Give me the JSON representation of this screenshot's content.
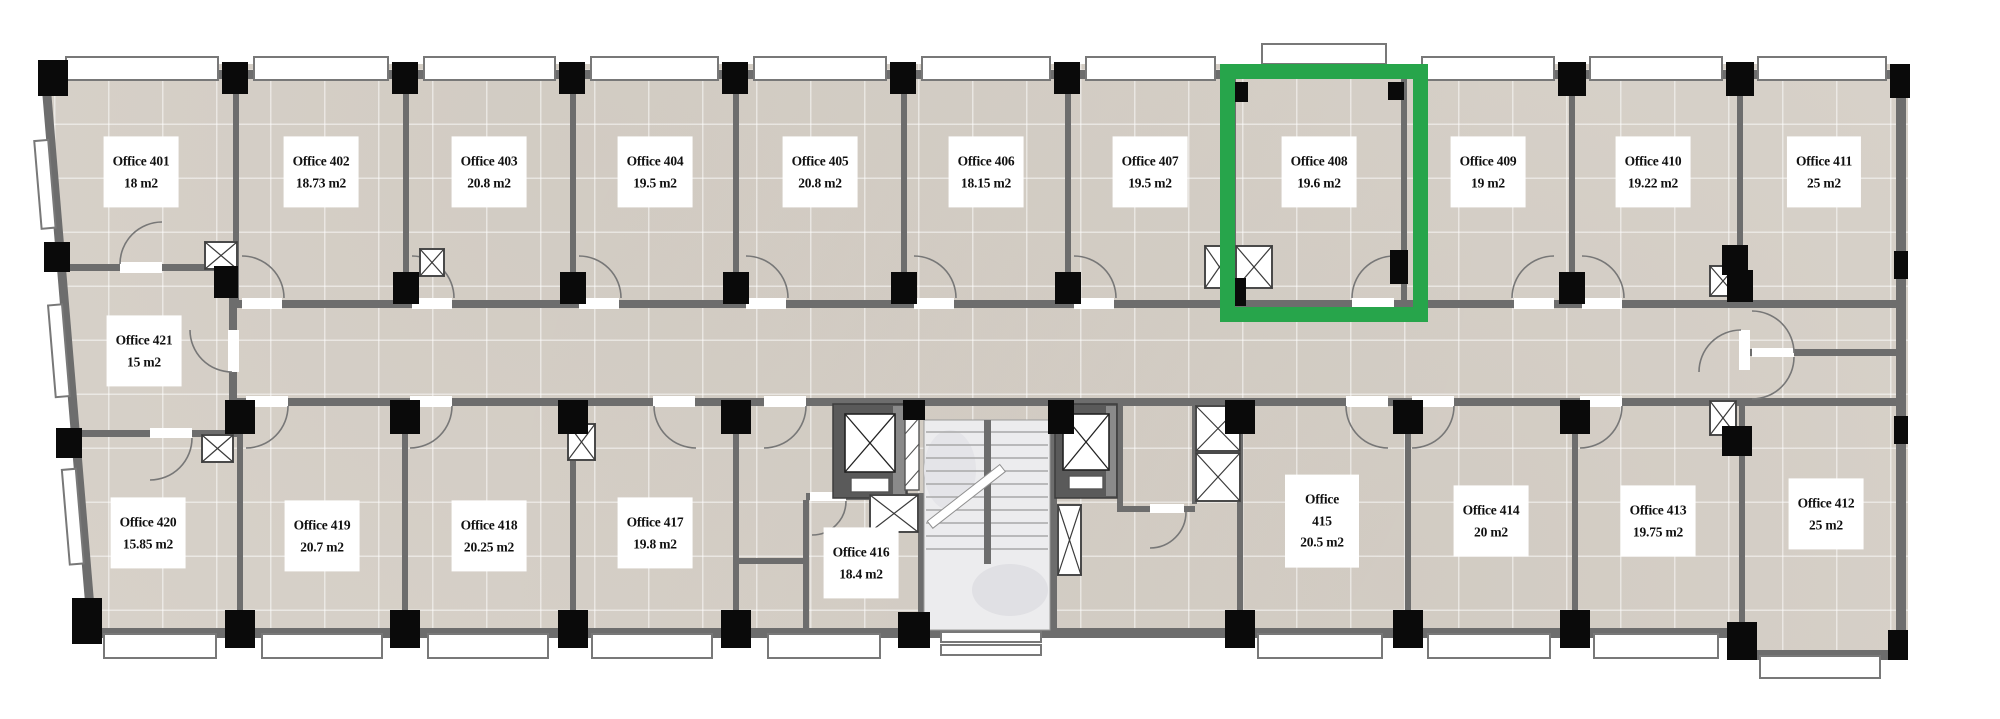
{
  "rooms": [
    {
      "name": "Office 401",
      "area": "18 m2",
      "highlighted": false
    },
    {
      "name": "Office 402",
      "area": "18.73 m2",
      "highlighted": false
    },
    {
      "name": "Office 403",
      "area": "20.8 m2",
      "highlighted": false
    },
    {
      "name": "Office 404",
      "area": "19.5 m2",
      "highlighted": false
    },
    {
      "name": "Office 405",
      "area": "20.8 m2",
      "highlighted": false
    },
    {
      "name": "Office 406",
      "area": "18.15 m2",
      "highlighted": false
    },
    {
      "name": "Office 407",
      "area": "19.5 m2",
      "highlighted": false
    },
    {
      "name": "Office 408",
      "area": "19.6 m2",
      "highlighted": true
    },
    {
      "name": "Office 409",
      "area": "19 m2",
      "highlighted": false
    },
    {
      "name": "Office 410",
      "area": "19.22 m2",
      "highlighted": false
    },
    {
      "name": "Office 411",
      "area": "25 m2",
      "highlighted": false
    },
    {
      "name": "Office 412",
      "area": "25 m2",
      "highlighted": false
    },
    {
      "name": "Office 413",
      "area": "19.75 m2",
      "highlighted": false
    },
    {
      "name": "Office 414",
      "area": "20 m2",
      "highlighted": false
    },
    {
      "name": "Office 415",
      "area": "20.5 m2",
      "highlighted": false
    },
    {
      "name": "Office 416",
      "area": "18.4 m2",
      "highlighted": false
    },
    {
      "name": "Office 417",
      "area": "19.8 m2",
      "highlighted": false
    },
    {
      "name": "Office 418",
      "area": "20.25 m2",
      "highlighted": false
    },
    {
      "name": "Office 419",
      "area": "20.7 m2",
      "highlighted": false
    },
    {
      "name": "Office 420",
      "area": "15.85 m2",
      "highlighted": false
    },
    {
      "name": "Office 421",
      "area": "15 m2",
      "highlighted": false
    }
  ],
  "highlight": {
    "room": "Office 408",
    "color": "#27a54b"
  },
  "colors": {
    "floor": "#d9d3cb",
    "wall": "#6d6d6d",
    "column": "#0a0a0a",
    "stairs": "#ececee"
  }
}
